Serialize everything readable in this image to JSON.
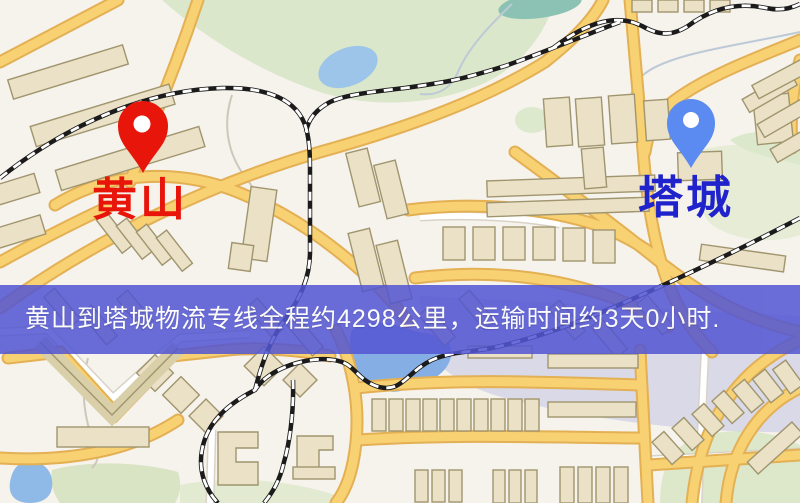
{
  "theme": {
    "banner-bg": "#5356d3",
    "banner-text-color": "#ffffff",
    "origin-color": "#e8150b",
    "dest-label-color": "#2022cc",
    "dest-pin-color": "#5b8bf0"
  },
  "map": {
    "origin_marker": {
      "label": "黄山",
      "pin_icon": "map-pin-icon",
      "pin_color": "#e8150b"
    },
    "dest_marker": {
      "label": "塔城",
      "pin_icon": "map-pin-icon",
      "pin_color": "#5b8bf0"
    },
    "banner": {
      "text": "黄山到塔城物流专线全程约4298公里，运输时间约3天0小时."
    },
    "style_colors": {
      "background": "#f6f2ec",
      "park_green": "#dbe7ca",
      "water_blue": "#8fb9e6",
      "road_yellow": "#f8d173",
      "railway_black": "#1b1b1b",
      "building_tan": "#eae1c6"
    }
  }
}
